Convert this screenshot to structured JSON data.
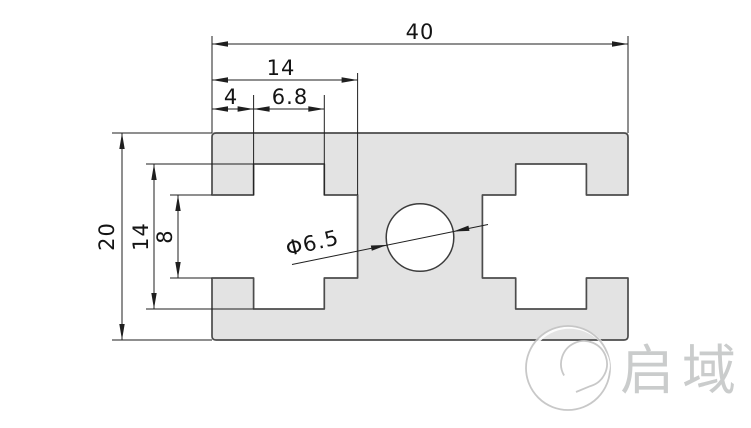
{
  "drawing": {
    "dimensions": {
      "overall_width": {
        "label": "40"
      },
      "slot_depth": {
        "label": "14"
      },
      "slot_throat": {
        "label": "4"
      },
      "slot_neck_width": {
        "label": "6.8"
      },
      "overall_height": {
        "label": "20"
      },
      "slot_inner_height": {
        "label": "14"
      },
      "slot_opening": {
        "label": "8"
      },
      "center_hole": {
        "label": "Φ6.5"
      }
    },
    "colors": {
      "profile_fill": "#e3e3e3",
      "profile_outline": "#4c4c4c",
      "dimension_lines": "#1f1f1f",
      "watermark_gray": "#c3c3c3",
      "background": "#ffffff"
    }
  },
  "watermark": {
    "brand": "启域"
  }
}
